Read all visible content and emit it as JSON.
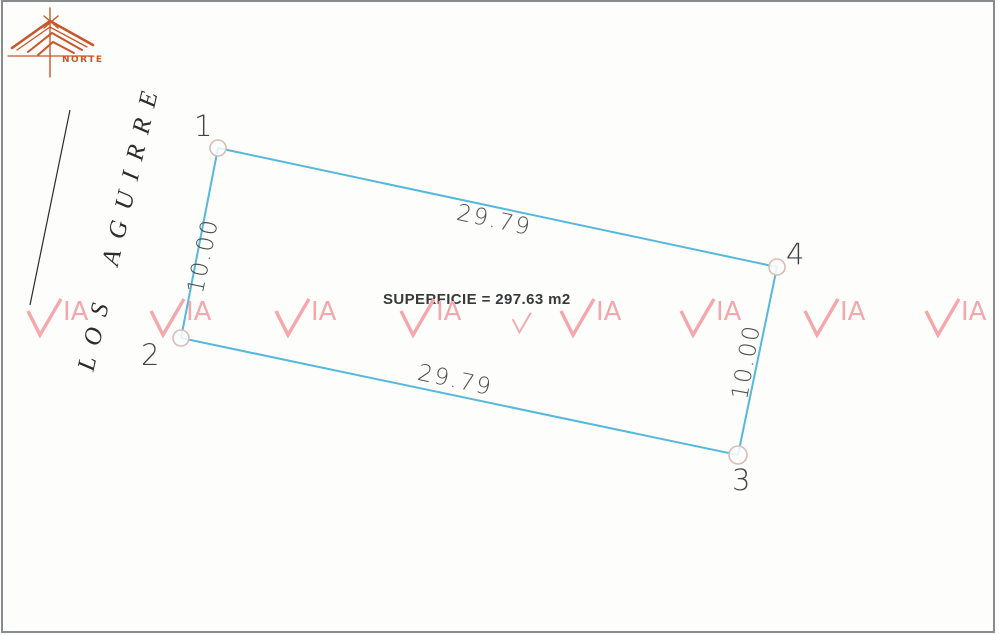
{
  "compass": {
    "label": "NORTE",
    "color": "#c8562a"
  },
  "street": {
    "name": "LOS AGUIRRE"
  },
  "parcel": {
    "area_text": "SUPERFICIE = 297.63 m2",
    "vertices": [
      {
        "label": "1"
      },
      {
        "label": "2"
      },
      {
        "label": "3"
      },
      {
        "label": "4"
      }
    ],
    "dimensions": {
      "top": "29.79",
      "bottom": "29.79",
      "left": "10.00",
      "right": "10.00"
    }
  },
  "watermark": {
    "text": "VIA"
  },
  "colors": {
    "parcel_line": "#56b8da",
    "vertex_marker": "#d8bcb8",
    "watermark": "#f4a7ac",
    "compass": "#c8562a",
    "ink": "#3f4346"
  }
}
